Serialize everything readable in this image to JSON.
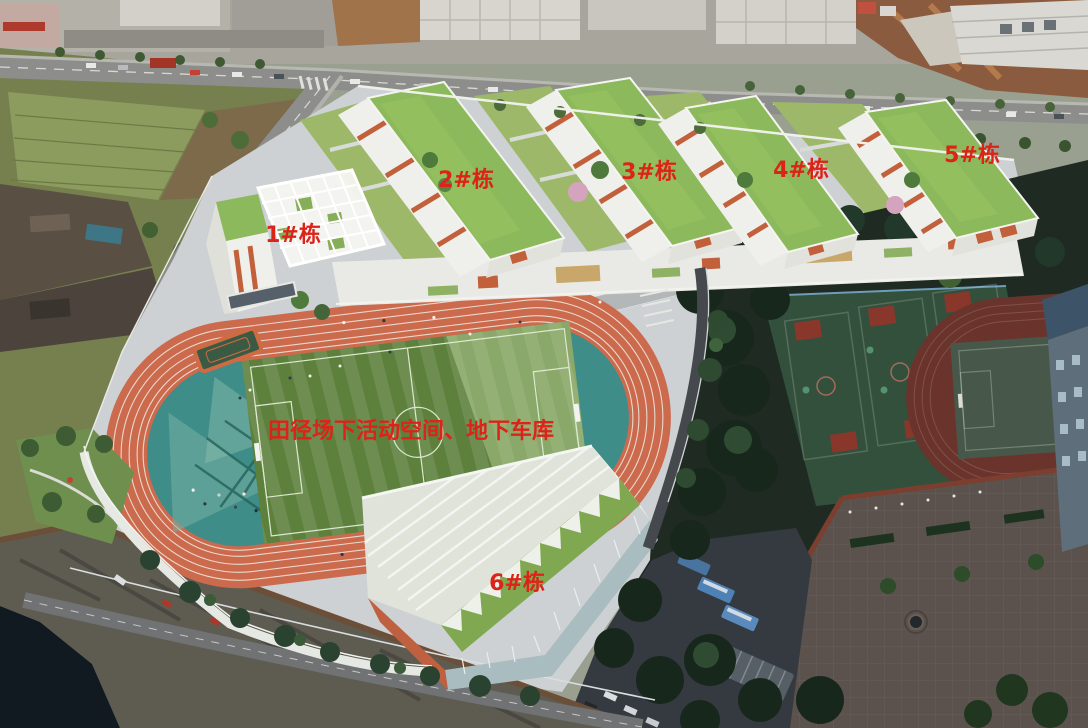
{
  "annotation": {
    "color": "#dd2318",
    "building_labels": [
      {
        "text": "1#栋",
        "x": 293,
        "y": 236
      },
      {
        "text": "2#栋",
        "x": 466,
        "y": 181
      },
      {
        "text": "3#栋",
        "x": 649,
        "y": 173
      },
      {
        "text": "4#栋",
        "x": 801,
        "y": 171
      },
      {
        "text": "5#栋",
        "x": 972,
        "y": 156
      },
      {
        "text": "6#栋",
        "x": 517,
        "y": 584
      }
    ],
    "area_label": {
      "text": "田径场下活动空间、地下车库",
      "x": 411,
      "y": 432
    }
  },
  "scene": {
    "description": "Aerial rendering of a school campus: six labeled buildings with green roofs, an elevated running track with teal activity ends and striped football pitch, basketball courts and an old track in shade at right, roads, construction site, cliff and water at lower left",
    "colors": {
      "campus_ground": "#cdd1d3",
      "green_roof": "#8cb95b",
      "facade_white": "#efefeb",
      "accent_orange": "#c2603b",
      "track_orange": "#cc6a4e",
      "teal_zone": "#3f8d88",
      "field_green": "#5d803c",
      "court_green": "#33503c",
      "court_red": "#8a372b",
      "old_track_red": "#6a342c",
      "tree_dark": "#1f2b22",
      "water": "#101a20",
      "rock": "#5e5c51",
      "road_gray": "#8d8e8c",
      "asphalt": "#343a40",
      "plaza_brown": "#5b524d",
      "dirt_brown": "#8a5b3e"
    }
  }
}
